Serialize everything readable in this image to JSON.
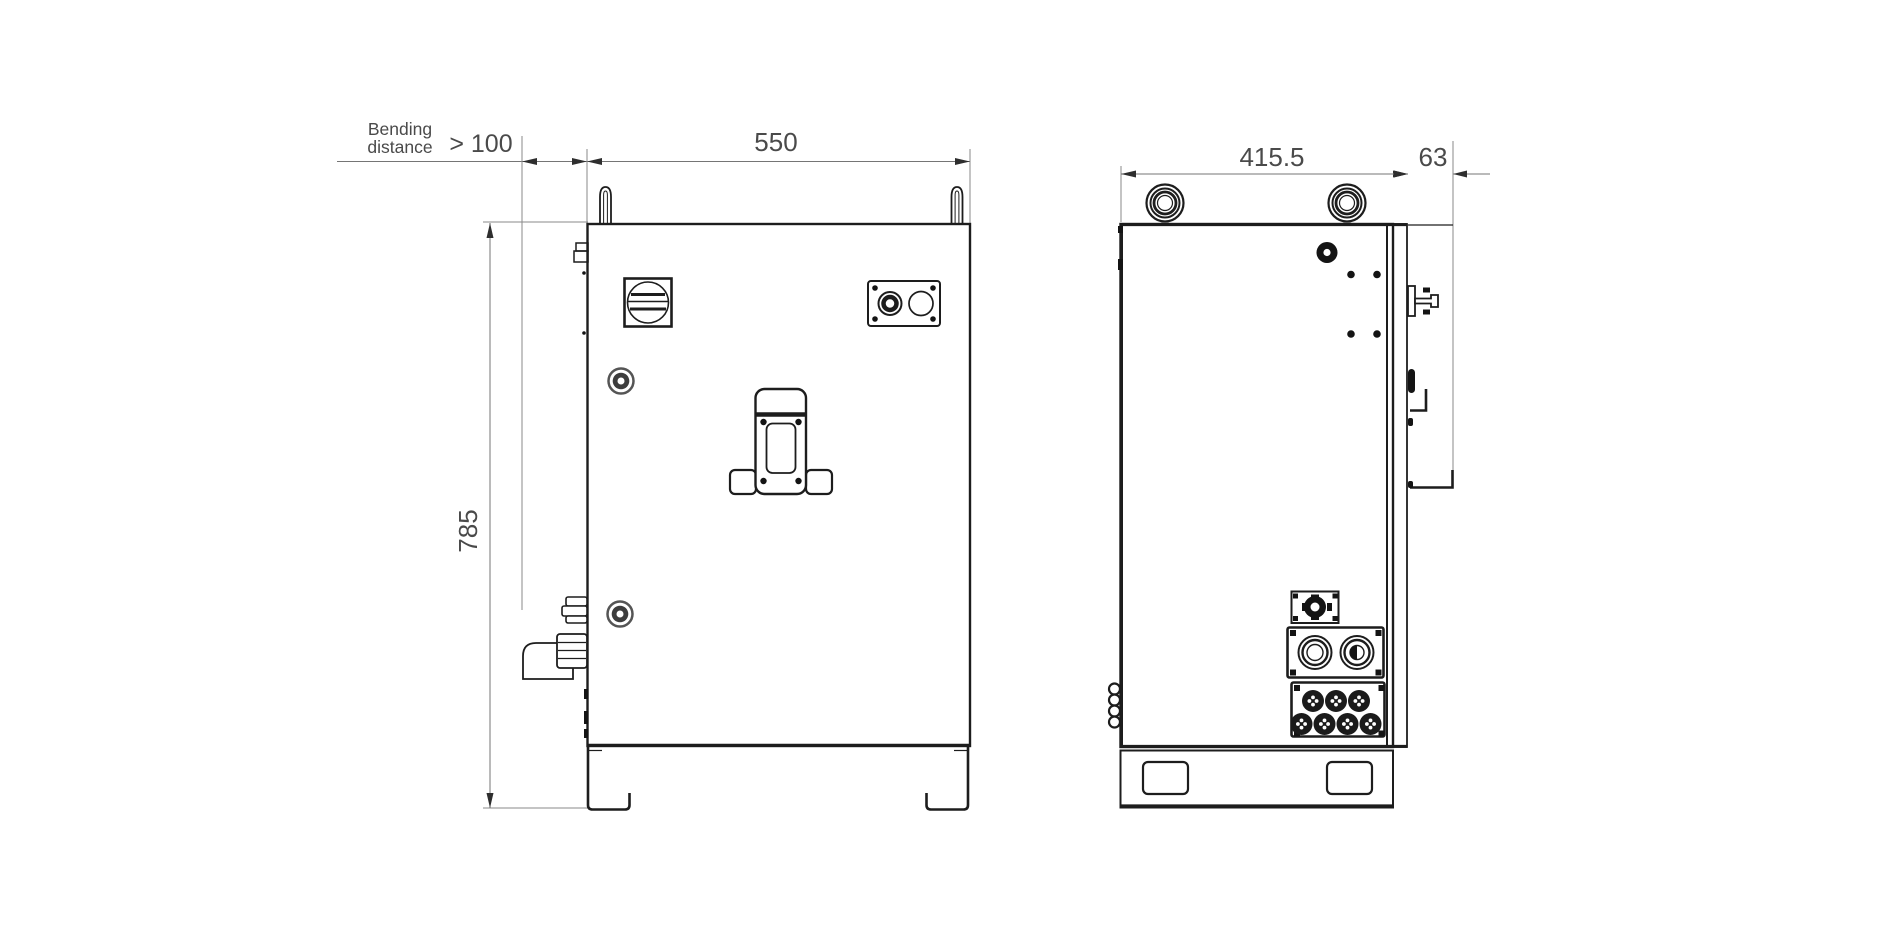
{
  "annotations": {
    "bending": {
      "line1": "Bending",
      "line2": "distance",
      "value": "> 100"
    },
    "front_width": "550",
    "front_height": "785",
    "side_width": "415.5",
    "door_depth": "63"
  },
  "colors": {
    "background": "#ffffff",
    "drawing_line": "#1d1d1d",
    "dimension_line": "#757575",
    "dimension_text": "#4a4a4a"
  }
}
